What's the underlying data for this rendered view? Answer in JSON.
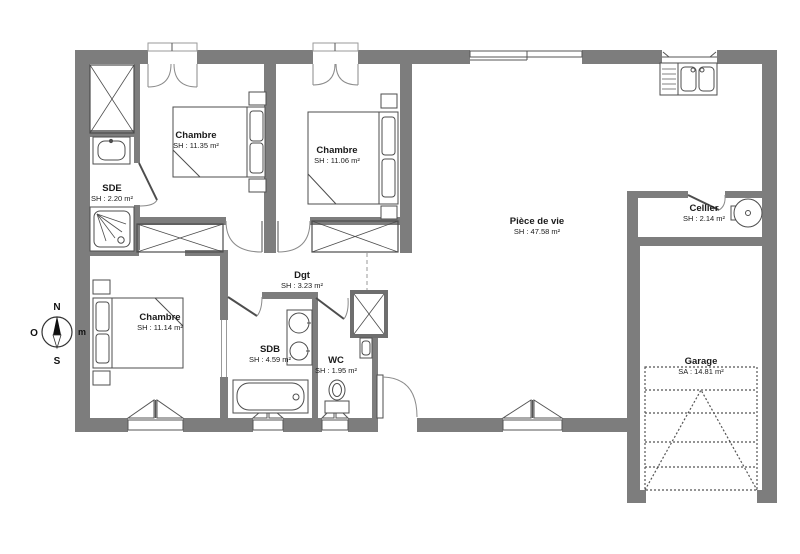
{
  "plan_title": "Plan de maison plain-pied 3 chambres avec garage",
  "rooms": {
    "chambre1": {
      "name": "Chambre",
      "area": "SH : 11.35 m²"
    },
    "chambre2": {
      "name": "Chambre",
      "area": "SH : 11.06 m²"
    },
    "chambre3": {
      "name": "Chambre",
      "area": "SH : 11.14 m²"
    },
    "sde": {
      "name": "SDE",
      "area": "SH : 2.20 m²"
    },
    "piece_de_vie": {
      "name": "Pièce de vie",
      "area": "SH : 47.58 m²"
    },
    "cellier": {
      "name": "Cellier",
      "area": "SH : 2.14 m²"
    },
    "dgt": {
      "name": "Dgt",
      "area": "SH : 3.23 m²"
    },
    "sdb": {
      "name": "SDB",
      "area": "SH : 4.59 m²"
    },
    "wc": {
      "name": "WC",
      "area": "SH : 1.95 m²"
    },
    "garage": {
      "name": "Garage",
      "area": "SA : 14.81 m²"
    }
  },
  "compass": {
    "north": "N",
    "west": "O",
    "south": "S",
    "east": "m"
  },
  "colors": {
    "wall": "#7d7d7d",
    "furniture_line": "#4d4d4d",
    "door_arc": "#8a8a8a",
    "dashed_line": "#555555",
    "text": "#1a1a1a",
    "background": "#ffffff"
  }
}
